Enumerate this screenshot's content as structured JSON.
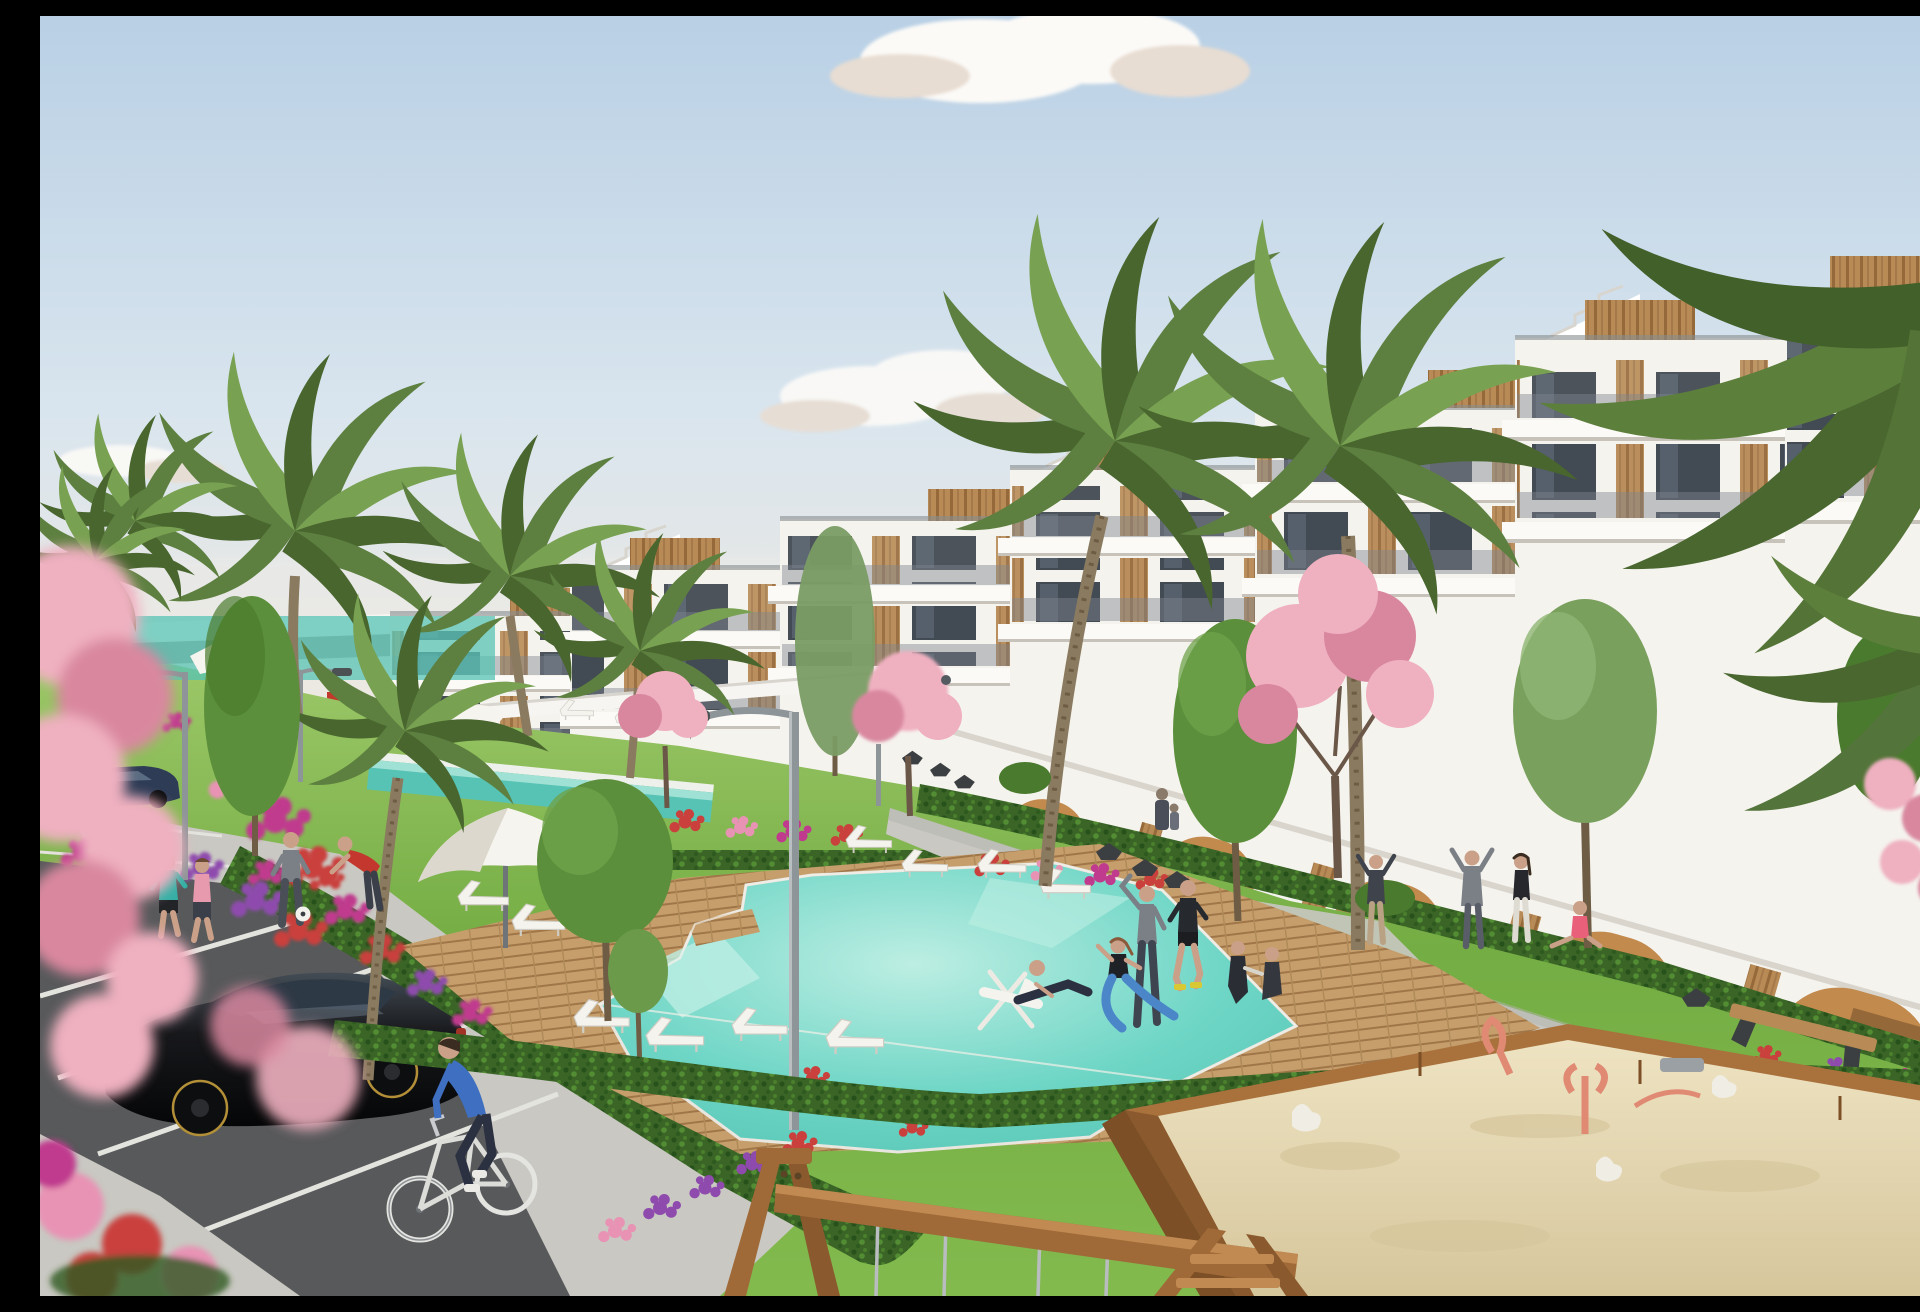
{
  "meta": {
    "description": "Sunny architectural rendering of a modern white apartment resort: stepped terraces with wood accents, palm and pink blossom trees, turquoise pools with wooden decks and white sun loungers, residents exercising, a parking lot with a black hatchback and a cyclist, and a children's sandbox with a wooden swing frame."
  },
  "palette": {
    "sky_top": "#b9d0e5",
    "sky_mid": "#d9e5ee",
    "sky_horizon": "#efe9e0",
    "cloud": "#fcfaf7",
    "cloud_shade": "#e8ddd2",
    "building": "#f5f3ee",
    "building_shade": "#e5e1da",
    "slab_line": "#c7c3bb",
    "roof_line": "#878d90",
    "window": "#39414b",
    "window_light": "#5c6b7a",
    "wood": "#b88a55",
    "wood_dark": "#96693a",
    "railing": "#7e868d",
    "arch": "#c28a4c",
    "arch_dark": "#8a5f34",
    "fence": "#f7f5f1",
    "grass_hi": "#9cc768",
    "grass": "#74ad43",
    "grass_lo": "#82ba4e",
    "hedge": "#3a6527",
    "hedge_dark": "#27511a",
    "hedge_light": "#538d33",
    "deck": "#c59e6c",
    "deck_line": "#a07648",
    "path": "#c9c8c2",
    "path_shade": "#b4b3ad",
    "asphalt": "#58595b",
    "white_line": "#e4e4df",
    "pool_deep": "#4dbfae",
    "pool_mid": "#6fd6c6",
    "pool_pale": "#bdeee3",
    "lap_pool": "#57c3b4",
    "sand": "#e8dcb8",
    "sand_shade": "#d6c69c",
    "box_wood": "#a9713c",
    "box_wood_dark": "#7c4f26",
    "swing_wood": "#a06a38",
    "lamp": "#8e9598",
    "lamp_dark": "#4c5154",
    "blossom": "#efb0c0",
    "blossom_deep": "#d9879f",
    "fl_red": "#c9403c",
    "fl_magenta": "#c03a8e",
    "fl_purple": "#8e4bad",
    "fl_pink": "#e893b4",
    "palm": "#5d8040",
    "palm_dark": "#48662e",
    "palm_light": "#79a152",
    "tree": "#5c8f3b",
    "tree_dark": "#4a7a2d",
    "trunk": "#8a7a5f",
    "trunk_dark": "#6e5d44",
    "skin": "#caa188",
    "car_black": "#17181b",
    "car_gloss": "#434c55",
    "car_navy": "#2e3c55",
    "tire": "#0d0e10",
    "rim": "#b39038",
    "shirt_teal": "#35b0a5",
    "shirt_pink": "#e79aae",
    "shirt_red": "#c4372e",
    "shirt_gray": "#7b7f86",
    "shirt_blue": "#3f6fc0",
    "pants_dark": "#2b3140",
    "shirt_black": "#26292e",
    "white": "#f4f3ee"
  },
  "scene": {
    "labels": {
      "sky": "pale blue sky with soft clouds",
      "buildings": "stepped white apartment blocks with rooftop wood boxes, glass balconies and wood panels",
      "arcade": "ground-floor arcade with ochre arched entrances",
      "pools": "turquoise swimming pools with wooden decks",
      "umbrella": "white pool parasol",
      "loungers": "white sun loungers",
      "parking": "asphalt parking lot with white bay lines",
      "car_black": "black hatchback car",
      "car_navy": "dark blue sedan",
      "cyclist": "man in blue shirt riding a white bicycle",
      "joggers": "two women jogging on the path",
      "soccer_man": "man in gray with a soccer ball",
      "red_man": "man in red shirt reaching down",
      "yoga_group": "residents exercising on the lawn",
      "walkway_people": "people stretching and sitting by the building walkway",
      "deckchair_man": "man relaxing in a white deck chair",
      "sandbox": "wooden sandbox with coral play sculptures",
      "swing": "wooden swing frame with steel cables",
      "palms": "tall palm trees",
      "blossoms": "pink blossom trees",
      "flowers": "beds of red, magenta and purple flowers",
      "lamps": "curved gray street lamps"
    },
    "counts": {
      "building_blocks": 7,
      "pools": 3,
      "loungers": 10,
      "people": 16,
      "cars": 3,
      "street_lamps": 3
    }
  }
}
